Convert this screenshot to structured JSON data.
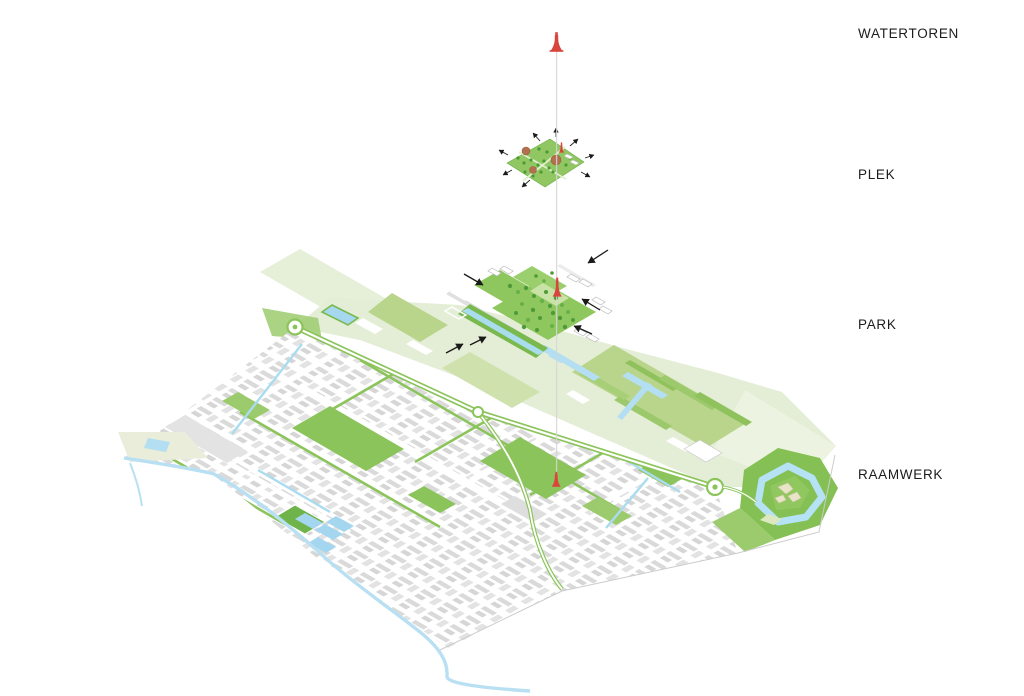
{
  "diagram": {
    "type": "exploded-axonometric-diagram",
    "layers": [
      {
        "id": "watertoren",
        "label": "WATERTOREN"
      },
      {
        "id": "plek",
        "label": "PLEK"
      },
      {
        "id": "park",
        "label": "PARK"
      },
      {
        "id": "raamwerk",
        "label": "RAAMWERK"
      }
    ],
    "colors": {
      "tower_red": "#d8453c",
      "park_green": "#8cc45c",
      "field_pale_green": "#e4eed6",
      "field_medium_green": "#b9d48b",
      "tree_dark_green": "#4f9a38",
      "water_blue": "#b4def2",
      "building_gray": "#d9d9d9",
      "soil_brown": "#b2714e",
      "connector_gray": "#d6d6d6",
      "label_text": "#1c1c1c"
    }
  }
}
